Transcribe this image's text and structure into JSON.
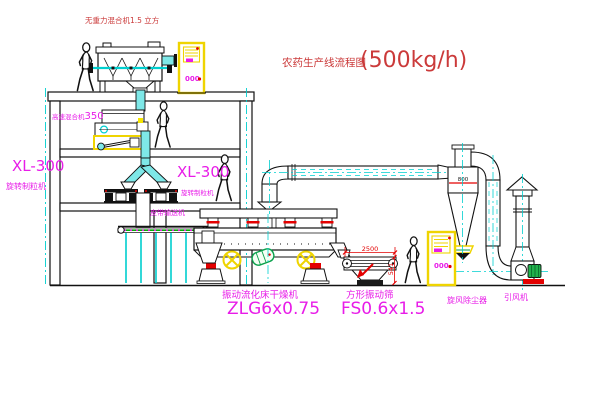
{
  "title": {
    "name": "农药生产线流程图",
    "capacity": "(500kg/h)"
  },
  "labels": {
    "gravity_mixer": "无重力混合机1.5 立方",
    "high_speed_mixer_name": "高速混合机",
    "high_speed_mixer_model": "350",
    "granulator_left_model": "XL-300",
    "granulator_left_name": "旋转制粒机",
    "granulator_right_model": "XL-300",
    "granulator_right_name": "旋转制粒机",
    "belt_conveyor": "皮带输送机",
    "dryer_name": "振动流化床干燥机",
    "dryer_model": "ZLG6x0.75",
    "sieve_name": "方形振动筛",
    "sieve_model": "FS0.6x1.5",
    "cyclone": "旋风除尘器",
    "fan": "引风机"
  },
  "dimensions": {
    "sieve_length": "2500",
    "sieve_height": "541",
    "cyclone_diameter": "800"
  },
  "cabinets": {
    "top_display": "000",
    "right_display": "000"
  },
  "colors": {
    "label_magenta": "#E81CE8",
    "annotation_red": "#CB3A3A",
    "dimension_red": "#E30000",
    "pipe_cyan": "#00CFCF",
    "cabinet_yellow": "#EFD400",
    "motor_green": "#21B14C",
    "line_black": "#111111"
  }
}
